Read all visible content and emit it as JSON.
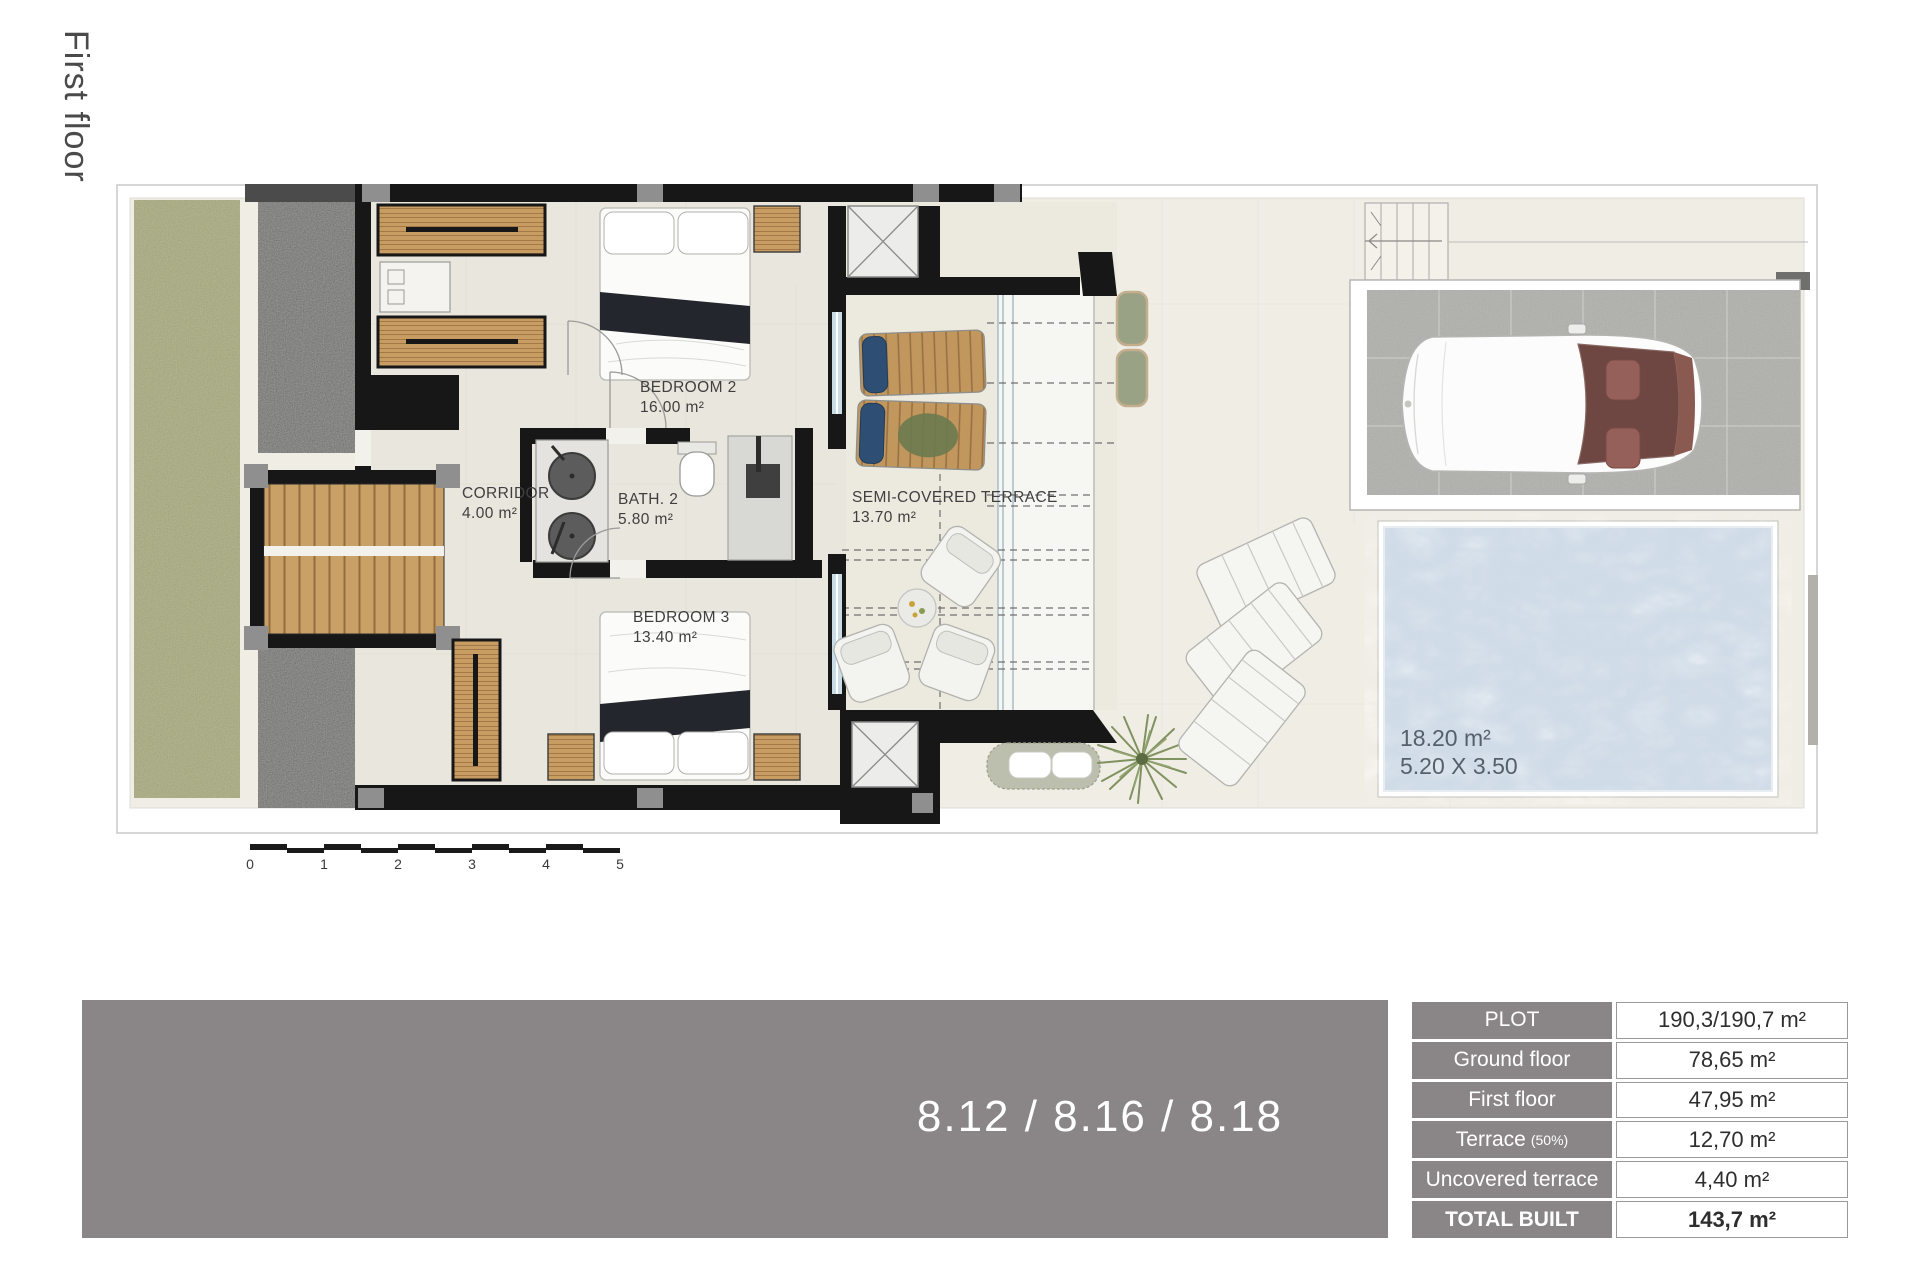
{
  "floor": {
    "label": "First floor"
  },
  "plan": {
    "rooms": {
      "bedroom2": {
        "name": "BEDROOM 2",
        "area": "16.00 m²"
      },
      "corridor": {
        "name": "CORRIDOR",
        "area": "4.00 m²"
      },
      "bath2": {
        "name": "BATH. 2",
        "area": "5.80 m²"
      },
      "bedroom3": {
        "name": "BEDROOM 3",
        "area": "13.40 m²"
      },
      "terrace": {
        "name": "SEMI-COVERED TERRACE",
        "area": "13.70 m²"
      }
    },
    "pool": {
      "area": "18.20 m²",
      "dimensions": "5.20 X 3.50"
    },
    "scale_ticks": [
      "0",
      "1",
      "2",
      "3",
      "4",
      "5"
    ]
  },
  "footer": {
    "units": "8.12 / 8.16 / 8.18",
    "table": {
      "rows": [
        {
          "label": "PLOT",
          "value": "190,3/190,7 m²"
        },
        {
          "label": "Ground floor",
          "value": "78,65 m²"
        },
        {
          "label": "First floor",
          "value": "47,95 m²"
        },
        {
          "label": "Terrace",
          "note": "(50%)",
          "value": "12,70 m²"
        },
        {
          "label": "Uncovered terrace",
          "value": "4,40 m²"
        },
        {
          "label": "TOTAL BUILT",
          "value": "143,7 m²"
        }
      ]
    }
  },
  "colors": {
    "banner": "#8A8687",
    "wall": "#171717",
    "pool_water": "#CFDBE7",
    "grass": "#B9BB8E",
    "gravel": "#9B9B99",
    "wood": "#C79D63",
    "lounger_blue": "#2E4F73"
  }
}
